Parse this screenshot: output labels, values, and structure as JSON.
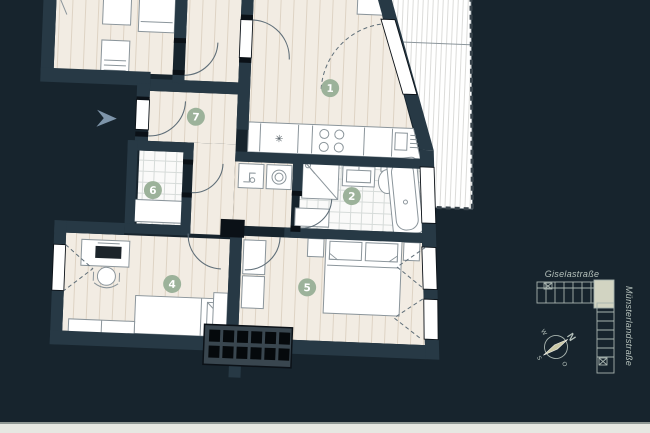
{
  "colors": {
    "background": "#17242d",
    "wall": "#273945",
    "post": "#0b1117",
    "floor": "#f2ece3",
    "floor_line": "#ded3c4",
    "tile": "#fafaf9",
    "tile_line": "#d6dbd9",
    "white": "#ffffff",
    "furn_stroke": "#8b959b",
    "arc": "#5f6e78",
    "badge": "#9cb29a",
    "balcony_line": "#dcdcda",
    "railing": "#39444c",
    "chimney_base": "#39464f",
    "chimney_cell": "#05090c",
    "arrow": "#7e95aa",
    "map_line": "#a7b3ae",
    "map_text": "#b6c2bc",
    "map_highlight": "#d2d4c2",
    "compass_needle": "#cac8a5",
    "footer": "#e6e8e2",
    "footer_line": "#8f9894"
  },
  "plan": {
    "rooms": [
      {
        "number": "1"
      },
      {
        "number": "2"
      },
      {
        "number": "4"
      },
      {
        "number": "5"
      },
      {
        "number": "6"
      },
      {
        "number": "7"
      }
    ],
    "icons": {
      "sink_star": "✳"
    }
  },
  "minimap": {
    "street_top": "Giselastraße",
    "street_right": "Münsterlandstraße",
    "compass": {
      "north": "N",
      "east": "O",
      "south": "S",
      "west": "W"
    }
  }
}
